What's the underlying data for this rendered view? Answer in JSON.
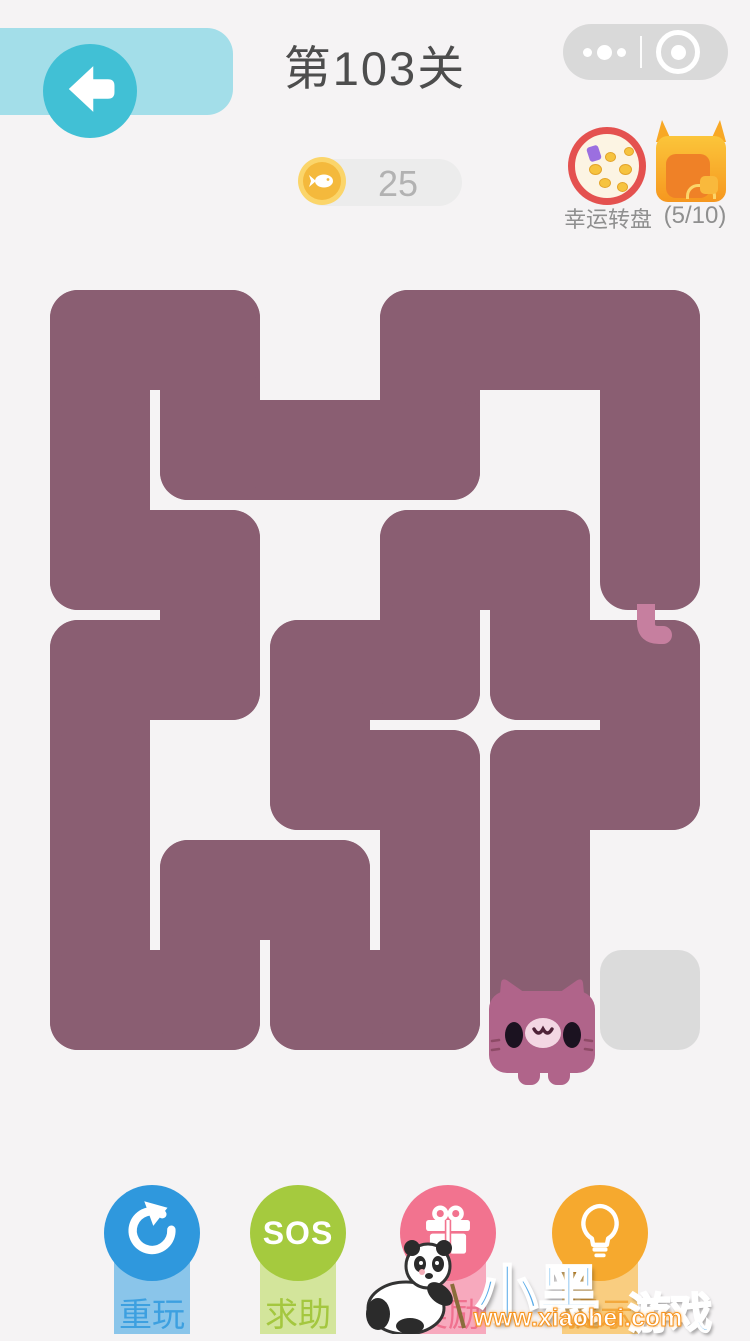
{
  "header": {
    "title": "第103关",
    "back_icon": "arrow-left",
    "wx_menu_icon": "more-dots",
    "wx_close_icon": "target-circle"
  },
  "hud": {
    "coins": "25",
    "coin_icon": "fish-coin",
    "wheel_label": "幸运转盘",
    "chest_progress": "(5/10)"
  },
  "board": {
    "cols": 6,
    "rows": 7,
    "origin_x": 45,
    "origin_y": 285,
    "cell": 110,
    "inset": 5,
    "radius": 28,
    "snake_path": [
      [
        5,
        2
      ],
      [
        5,
        1
      ],
      [
        5,
        0
      ],
      [
        4,
        0
      ],
      [
        3,
        0
      ],
      [
        3,
        1
      ],
      [
        2,
        1
      ],
      [
        1,
        1
      ],
      [
        1,
        0
      ],
      [
        0,
        0
      ],
      [
        0,
        1
      ],
      [
        0,
        2
      ],
      [
        1,
        2
      ],
      [
        1,
        3
      ],
      [
        0,
        3
      ],
      [
        0,
        4
      ],
      [
        0,
        5
      ],
      [
        0,
        6
      ],
      [
        1,
        6
      ],
      [
        1,
        5
      ],
      [
        2,
        5
      ],
      [
        2,
        6
      ],
      [
        3,
        6
      ],
      [
        3,
        5
      ],
      [
        3,
        4
      ],
      [
        2,
        4
      ],
      [
        2,
        3
      ],
      [
        3,
        3
      ],
      [
        3,
        2
      ],
      [
        4,
        2
      ],
      [
        4,
        3
      ],
      [
        5,
        3
      ],
      [
        5,
        4
      ],
      [
        4,
        4
      ],
      [
        4,
        5
      ],
      [
        4,
        6
      ]
    ],
    "tail_cell": [
      5,
      2
    ],
    "head_cell": [
      4,
      6
    ],
    "target_cell": [
      5,
      6
    ],
    "colors": {
      "background": "#f5f3f4",
      "snake": "#8a5e72",
      "head": "#b0648a",
      "tail": "#c67f9f",
      "target": "#dbdbdb"
    }
  },
  "buttons": [
    {
      "id": "replay",
      "label": "重玩",
      "icon": "refresh-icon",
      "circle": "#2f98dd",
      "pill": "#8ac5ea"
    },
    {
      "id": "sos",
      "label": "求助",
      "icon_text": "SOS",
      "circle": "#a5ca3e",
      "pill": "#d3e59b"
    },
    {
      "id": "reward",
      "label": "奖励",
      "icon": "gift-icon",
      "circle": "#f2738f",
      "pill": "#f7a9bd"
    },
    {
      "id": "hint",
      "label": "提示",
      "icon": "bulb-icon",
      "circle": "#f6a92e",
      "pill": "#f9cd80"
    }
  ],
  "watermark": {
    "brand": "小黑",
    "brand_suffix": "游戏",
    "url": "www.xiaohei.com"
  }
}
